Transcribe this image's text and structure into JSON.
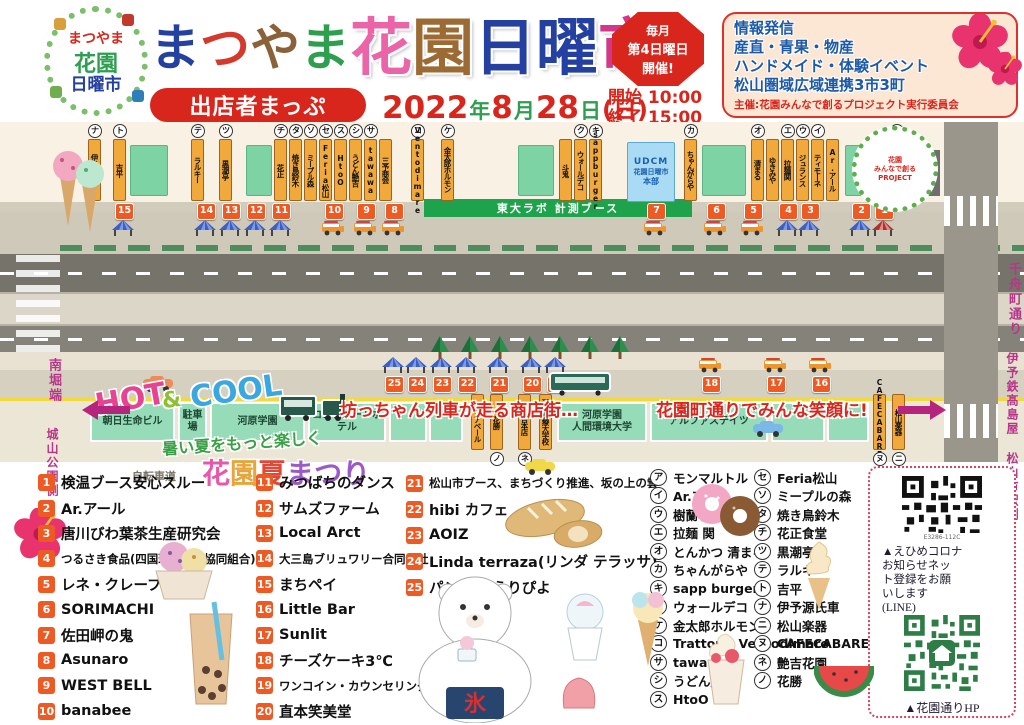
{
  "header": {
    "logo": {
      "line1": "まつやま",
      "line2": "花園",
      "line3": "日曜市"
    },
    "title_chars": [
      {
        "ch": "ま",
        "color": "#2440a0",
        "s": "s1"
      },
      {
        "ch": "つ",
        "color": "#d33a2c",
        "s": "s1"
      },
      {
        "ch": "や",
        "color": "#8a623a",
        "s": "s1"
      },
      {
        "ch": "ま",
        "color": "#2e9e4f",
        "s": "s1"
      },
      {
        "ch": "花",
        "color": "#ec64a8",
        "s": "s2"
      },
      {
        "ch": "園",
        "color": "#9c6b33",
        "s": "s2"
      },
      {
        "ch": "日",
        "color": "#2440a0",
        "s": "s2"
      },
      {
        "ch": "曜",
        "color": "#2440a0",
        "s": "s2"
      },
      {
        "ch": "市",
        "color": "#d2378c",
        "s": "s2"
      }
    ],
    "subtitle": "出店者まっぷ",
    "date_parts": [
      {
        "t": "2022",
        "c": "n"
      },
      {
        "t": "年",
        "c": "k"
      },
      {
        "t": "8",
        "c": "n"
      },
      {
        "t": "月",
        "c": "k"
      },
      {
        "t": "28",
        "c": "n"
      },
      {
        "t": "日",
        "c": "k"
      },
      {
        "t": "(日)",
        "c": "p"
      }
    ],
    "badge_lines": [
      "毎月",
      "第4日曜日",
      "開催!"
    ],
    "badge_sizes": [
      12,
      13,
      13
    ],
    "times": "開始 10:00\n終了 15:00",
    "info_lines": [
      "情報発信",
      "産直・青果・物産",
      "ハンドメイド・体験イベント",
      "松山圏域広域連携3市3町"
    ],
    "info_footer": "主催:花園みんなで創るプロジェクト実行委員会"
  },
  "map": {
    "left_labels": [
      "南堀端",
      "城山公園側"
    ],
    "right_labels": [
      "千舟町通り",
      "伊予鉄髙島屋",
      "松山市駅側"
    ],
    "banner": "東大ラボ 計測ブース",
    "hq_box": {
      "line1": "UDCM",
      "line2": "花園日曜市",
      "line3": "本部"
    },
    "overlays": {
      "hot": "HOT",
      "amp": "&",
      "cool": "COOL",
      "summer": "暑い夏をもっと楽しく",
      "festival_chars": [
        {
          "ch": "花",
          "color": "#e858a8"
        },
        {
          "ch": "園",
          "color": "#e8a53c"
        },
        {
          "ch": "夏",
          "color": "#e04838"
        },
        {
          "ch": "ま",
          "color": "#9a5ac8"
        },
        {
          "ch": "つ",
          "color": "#9a5ac8"
        },
        {
          "ch": "り",
          "color": "#9a5ac8"
        }
      ],
      "train_text": "坊っちゃん列車が走る商店街…",
      "smile_text": "花園町通りでみんな笑顔に!",
      "bike_path": "自転車道",
      "bear_cloth": "氷",
      "project_logo_lines": [
        "花園",
        "みんなで創る",
        "PROJECT"
      ]
    },
    "top_tabs": [
      {
        "letter": "ナ",
        "name": "伊予源氏車",
        "x": 88
      },
      {
        "letter": "ト",
        "name": "吉平",
        "x": 113
      },
      {
        "type": "block",
        "x": 130,
        "w": 38
      },
      {
        "letter": "テ",
        "name": "ラルキー",
        "x": 191
      },
      {
        "letter": "ツ",
        "name": "黒潮亭",
        "x": 219
      },
      {
        "type": "block",
        "x": 246,
        "w": 26
      },
      {
        "letter": "チ",
        "name": "花正",
        "x": 274
      },
      {
        "letter": "タ",
        "name": "焼き鳥鈴木",
        "x": 289
      },
      {
        "letter": "ソ",
        "name": "ミープル森",
        "x": 304
      },
      {
        "letter": "セ",
        "name": "Feria松山",
        "x": 319
      },
      {
        "letter": "ス",
        "name": "HtoO",
        "x": 334
      },
      {
        "letter": "シ",
        "name": "うどん艶吉",
        "x": 349
      },
      {
        "letter": "サ",
        "name": "tawawa",
        "x": 364
      },
      {
        "letter": "",
        "name": "三予商会",
        "x": 379
      },
      {
        "letter": "コ",
        "name": "Ventodimare",
        "x": 411
      },
      {
        "letter": "ケ",
        "name": "金太郎ホルモン",
        "x": 441
      },
      {
        "type": "block",
        "x": 518,
        "w": 36
      },
      {
        "letter": "",
        "name": "斗鬼",
        "x": 559
      },
      {
        "letter": "ク",
        "name": "ウォールデコ",
        "x": 574
      },
      {
        "letter": "キ",
        "name": "sappburger",
        "x": 589
      },
      {
        "letter": "カ",
        "name": "ちゃんがらや",
        "x": 684
      },
      {
        "type": "block",
        "x": 702,
        "w": 44
      },
      {
        "letter": "オ",
        "name": "清まる",
        "x": 751
      },
      {
        "letter": "",
        "name": "ゆきみや",
        "x": 766
      },
      {
        "letter": "エ",
        "name": "拉麺関",
        "x": 781
      },
      {
        "letter": "ウ",
        "name": "ジュランス",
        "x": 796
      },
      {
        "letter": "イ",
        "name": "ティモーネ",
        "x": 811
      },
      {
        "letter": "",
        "name": "Ar.アール",
        "x": 826
      },
      {
        "type": "block",
        "x": 845,
        "w": 40
      },
      {
        "letter": "ア",
        "name": "モンマルトル",
        "x": 890
      }
    ],
    "bottom_row": [
      {
        "type": "bldg",
        "name": "朝日生命ビル",
        "x": 90,
        "w": 85
      },
      {
        "type": "bldg",
        "name": "駐車場",
        "x": 178,
        "w": 29
      },
      {
        "type": "bldg",
        "name": "河原学園",
        "x": 210,
        "w": 95
      },
      {
        "type": "bldg",
        "name": "コンフォートホテル",
        "x": 308,
        "w": 78
      },
      {
        "type": "bldg",
        "name": "",
        "x": 389,
        "w": 38
      },
      {
        "type": "bldg",
        "name": "",
        "x": 429,
        "w": 34
      },
      {
        "type": "shop",
        "letter": "",
        "name": "クリアベール",
        "x": 471
      },
      {
        "type": "shop",
        "letter": "ノ",
        "name": "花勝",
        "x": 490
      },
      {
        "type": "shop",
        "letter": "ネ",
        "name": "艶吉本店",
        "x": 518
      },
      {
        "type": "shop",
        "letter": "",
        "name": "河原医療大学校",
        "x": 539
      },
      {
        "type": "bldg",
        "name": "河原学園\n人間環境大学",
        "x": 557,
        "w": 90
      },
      {
        "type": "bldg",
        "name": "アルファステイツ",
        "x": 650,
        "w": 118
      },
      {
        "type": "bldg",
        "name": "",
        "x": 771,
        "w": 54
      },
      {
        "type": "bldg",
        "name": "",
        "x": 827,
        "w": 42
      },
      {
        "type": "shop",
        "letter": "ヌ",
        "name": "CAFECABARET",
        "x": 873
      },
      {
        "type": "shop",
        "letter": "ニ",
        "name": "松山楽器",
        "x": 892
      }
    ],
    "stalls_top": [
      {
        "n": "15",
        "t": "tentb",
        "x": 115
      },
      {
        "n": "14",
        "t": "tentb",
        "x": 197
      },
      {
        "n": "13",
        "t": "tentb",
        "x": 222
      },
      {
        "n": "12",
        "t": "tentb",
        "x": 247
      },
      {
        "n": "11",
        "t": "tentb",
        "x": 272
      },
      {
        "n": "10",
        "t": "truck",
        "x": 325
      },
      {
        "n": "9",
        "t": "truck",
        "x": 357
      },
      {
        "n": "8",
        "t": "truck",
        "x": 385
      },
      {
        "n": "7",
        "t": "truck",
        "x": 647
      },
      {
        "n": "6",
        "t": "truck",
        "x": 707
      },
      {
        "n": "5",
        "t": "truck",
        "x": 744
      },
      {
        "n": "4",
        "t": "tentb",
        "x": 779
      },
      {
        "n": "3",
        "t": "tentb",
        "x": 801
      },
      {
        "n": "2",
        "t": "tentb",
        "x": 852
      },
      {
        "n": "1",
        "t": "tentr",
        "x": 875
      }
    ],
    "stalls_bottom": [
      {
        "n": "25",
        "t": "tentb",
        "x": 385
      },
      {
        "n": "24",
        "t": "tentb",
        "x": 408
      },
      {
        "n": "23",
        "t": "tentb",
        "x": 433
      },
      {
        "n": "22",
        "t": "tentb",
        "x": 458
      },
      {
        "n": "21",
        "t": "tentb",
        "x": 490
      },
      {
        "n": "20",
        "t": "tentb",
        "x": 523
      },
      {
        "n": "19",
        "t": "tentb",
        "x": 547
      },
      {
        "n": "18",
        "t": "truck",
        "x": 702
      },
      {
        "n": "17",
        "t": "truck",
        "x": 767
      },
      {
        "n": "16",
        "t": "truck",
        "x": 812
      }
    ]
  },
  "directory": {
    "col1": [
      {
        "num": "1",
        "label": "検温ブース安心スルー"
      },
      {
        "num": "2",
        "label": "Ar.アール"
      },
      {
        "num": "3",
        "label": "唐川びわ葉茶生産研究会"
      },
      {
        "num": "4",
        "label": "つるさき食品(四国珍味商工協同組合)",
        "size": "sm"
      },
      {
        "num": "5",
        "label": "レネ・クレープ"
      },
      {
        "num": "6",
        "label": "SORIMACHI"
      },
      {
        "num": "7",
        "label": "佐田岬の鬼"
      },
      {
        "num": "8",
        "label": "Asunaro"
      },
      {
        "num": "9",
        "label": "WEST BELL"
      },
      {
        "num": "10",
        "label": "banabee"
      }
    ],
    "col2": [
      {
        "num": "11",
        "label": "みつばちのダンス"
      },
      {
        "num": "12",
        "label": "サムズファーム"
      },
      {
        "num": "13",
        "label": "Local Arct"
      },
      {
        "num": "14",
        "label": "大三島ブリュワリー合同会社",
        "size": "sm"
      },
      {
        "num": "15",
        "label": "まちペイ"
      },
      {
        "num": "16",
        "label": "Little Bar"
      },
      {
        "num": "17",
        "label": "Sunlit"
      },
      {
        "num": "18",
        "label": "チーズケーキ3℃"
      },
      {
        "num": "19",
        "label": "ワンコイン・カウンセリング",
        "size": "sm"
      },
      {
        "num": "20",
        "label": "直本笑美堂"
      }
    ],
    "col3": [
      {
        "num": "21",
        "label": "松山市ブース、まちづくり推進、坂の上の雲",
        "size": "sm"
      },
      {
        "num": "22",
        "label": "hibi カフェ"
      },
      {
        "num": "23",
        "label": "AOIZ"
      },
      {
        "num": "24",
        "label": "Linda terraza(リンダ テラッサ)"
      },
      {
        "num": "25",
        "label": "パン工房 えりぴよ"
      }
    ],
    "col4": [
      {
        "letter": "ア",
        "label": "モンマルトル"
      },
      {
        "letter": "イ",
        "label": "Ar.アール"
      },
      {
        "letter": "ウ",
        "label": "樹蘭子"
      },
      {
        "letter": "エ",
        "label": "拉麺 関"
      },
      {
        "letter": "オ",
        "label": "とんかつ 清まる"
      },
      {
        "letter": "カ",
        "label": "ちゃんがらや"
      },
      {
        "letter": "キ",
        "label": "sapp burger"
      },
      {
        "letter": "ク",
        "label": "ウォールデコ"
      },
      {
        "letter": "ケ",
        "label": "金太郎ホルモン"
      },
      {
        "letter": "コ",
        "label": "Trattoria Ventodimare"
      },
      {
        "letter": "サ",
        "label": "tawawa"
      },
      {
        "letter": "シ",
        "label": "うどん艶吉"
      },
      {
        "letter": "ス",
        "label": "HtoO"
      }
    ],
    "col5": [
      {
        "letter": "セ",
        "label": "Feria松山"
      },
      {
        "letter": "ソ",
        "label": "ミープルの森"
      },
      {
        "letter": "タ",
        "label": "焼き鳥鈴木"
      },
      {
        "letter": "チ",
        "label": "花正食堂"
      },
      {
        "letter": "ツ",
        "label": "黒潮亭"
      },
      {
        "letter": "テ",
        "label": "ラルキー"
      },
      {
        "letter": "ト",
        "label": "吉平"
      },
      {
        "letter": "ナ",
        "label": "伊予源氏車"
      },
      {
        "letter": "ニ",
        "label": "松山楽器"
      },
      {
        "letter": "ヌ",
        "label": "CAFECABARET"
      },
      {
        "letter": "ネ",
        "label": "艶吉花園"
      },
      {
        "letter": "ノ",
        "label": "花勝"
      }
    ]
  },
  "qr": {
    "code": "E3286-112C",
    "caption1_lines": [
      "▲えひめコロナ",
      "お知らせネッ",
      "ト登録をお願",
      "いします",
      "(LINE)"
    ],
    "caption2": "▲花園通りHP"
  }
}
